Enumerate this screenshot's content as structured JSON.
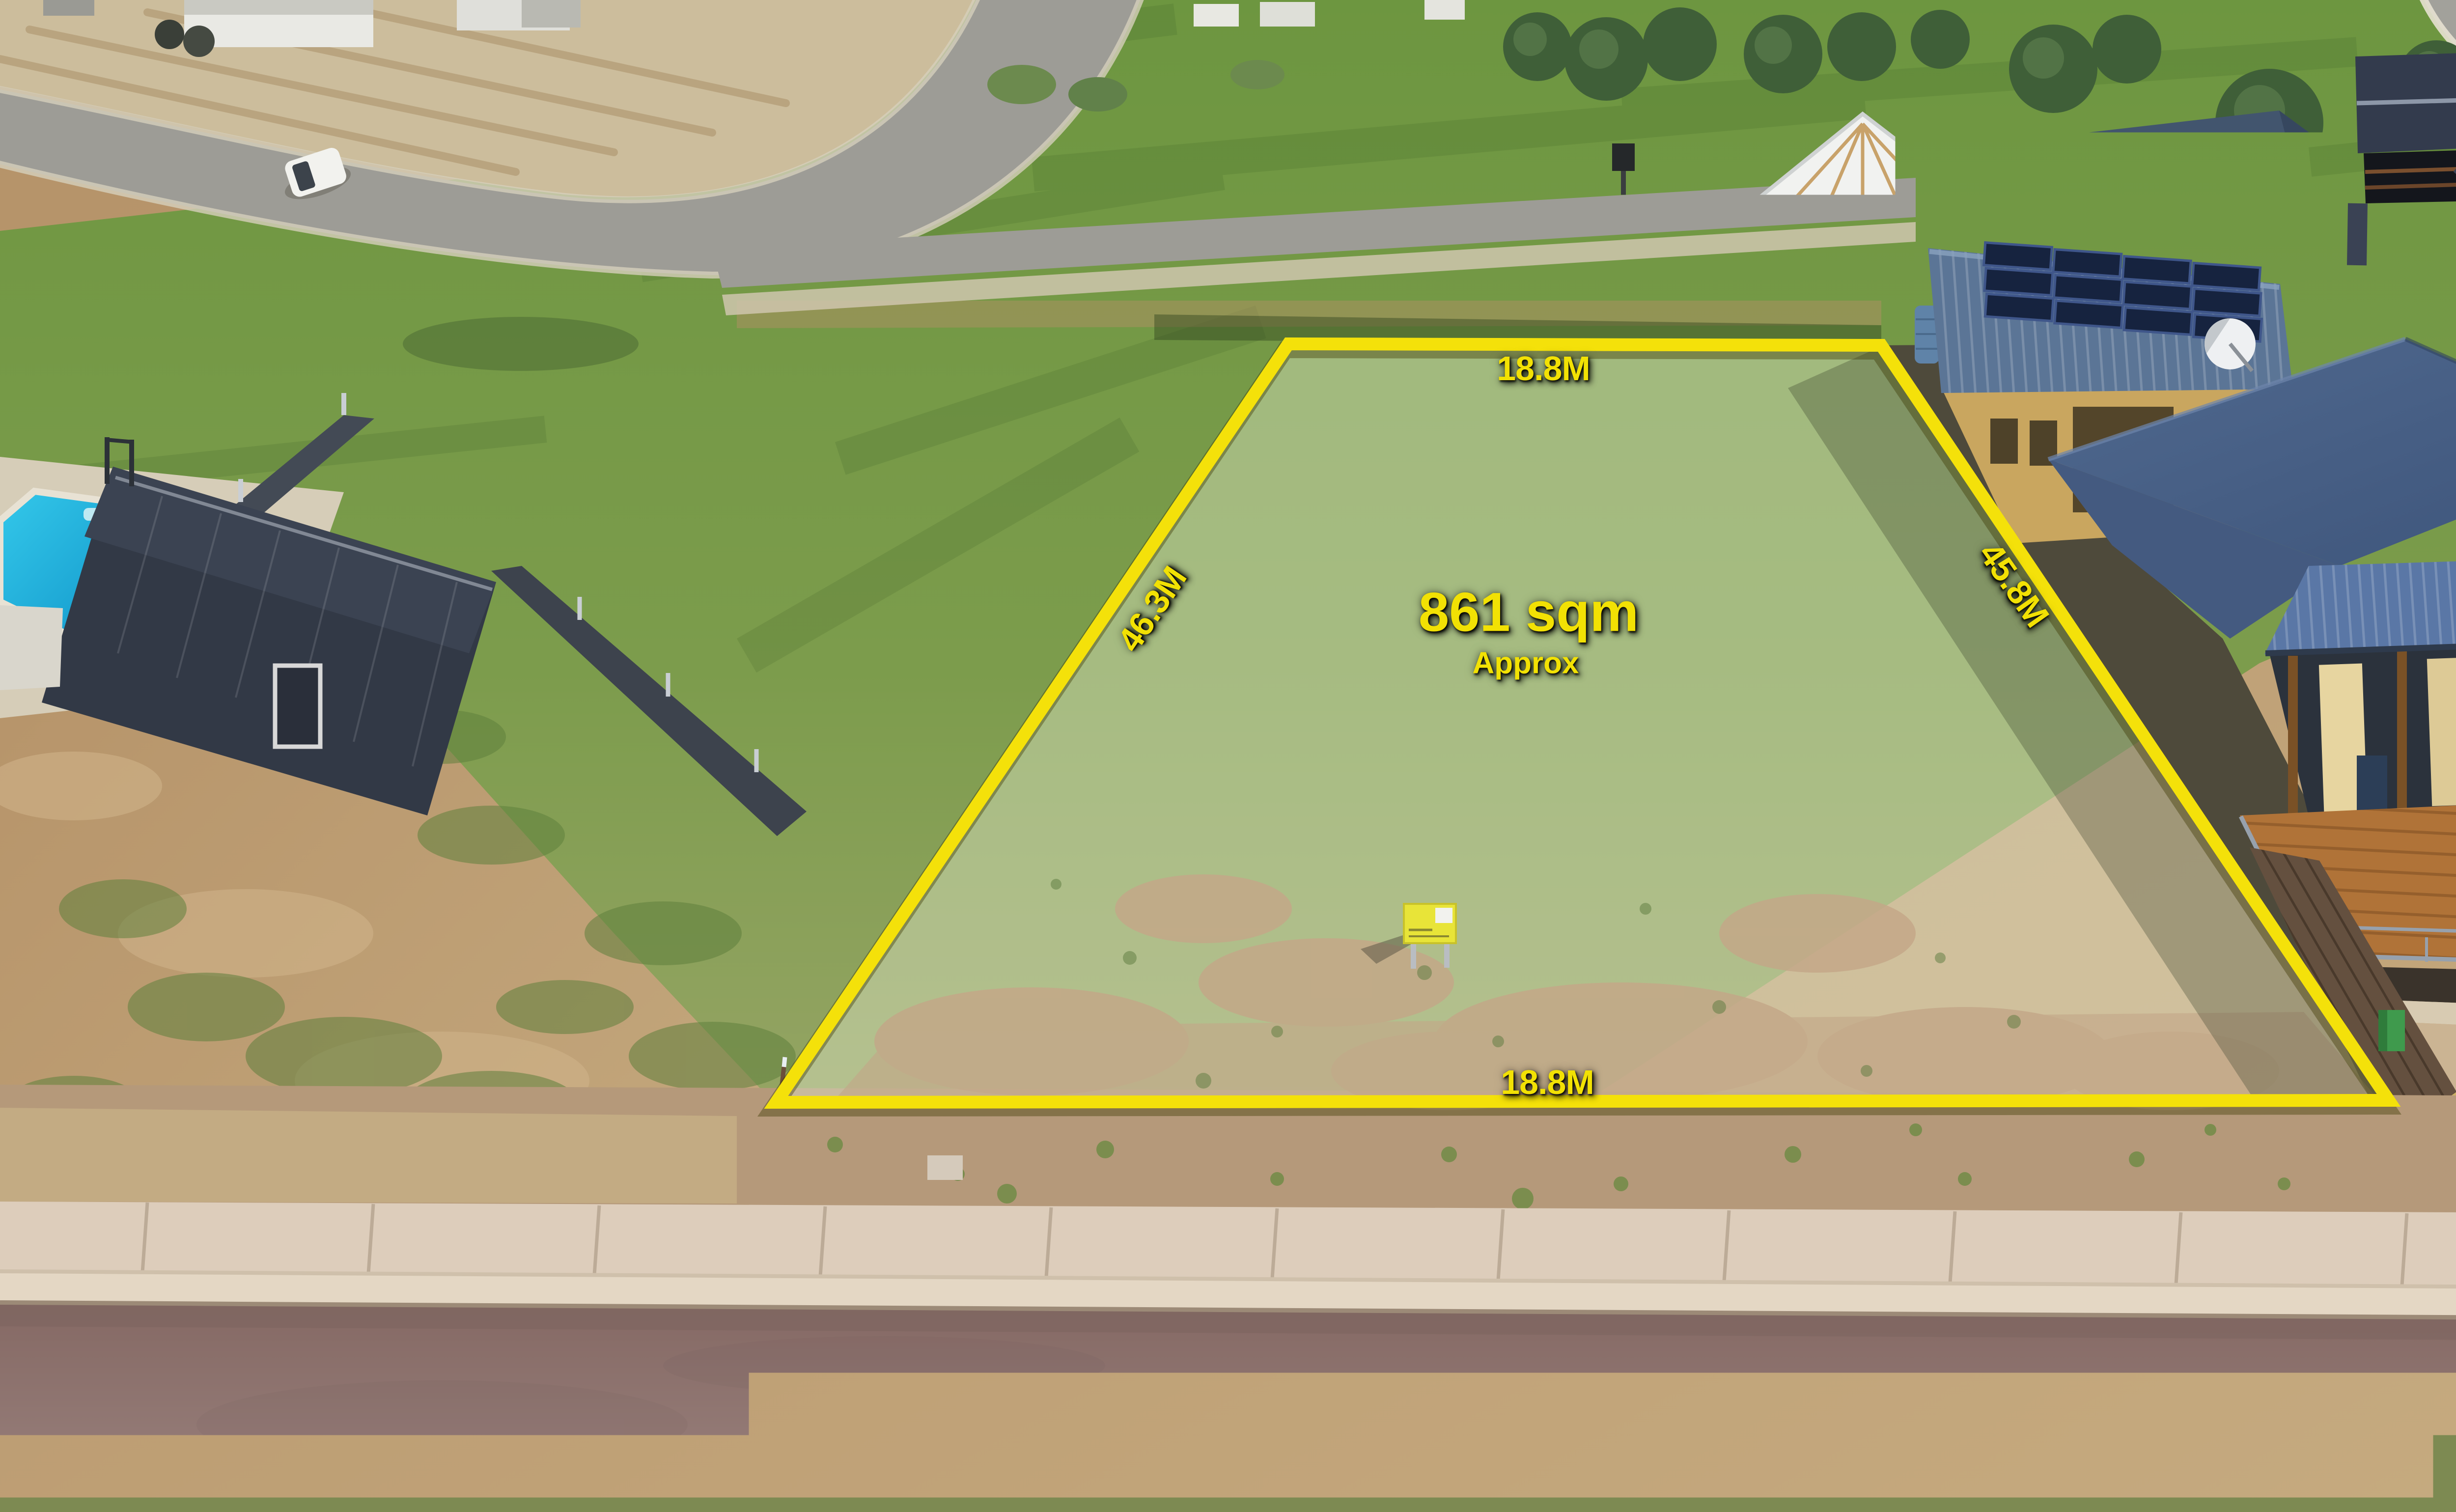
{
  "annotations": {
    "area_label": {
      "value": "861 sqm",
      "qualifier": "Approx"
    },
    "dimension_labels": {
      "top": "18.8M",
      "bottom": "18.8M",
      "left": "46.3M",
      "right": "45.8M"
    },
    "street_label": "Oscar Williams Drive",
    "colors": {
      "boundary": "#F4E10A",
      "label_text": "#F2E104"
    }
  },
  "scene": {
    "type": "aerial-drone-photo",
    "subject": "vacant residential allotment outlined in yellow",
    "for_sale_sign_color": "#E8E438"
  }
}
